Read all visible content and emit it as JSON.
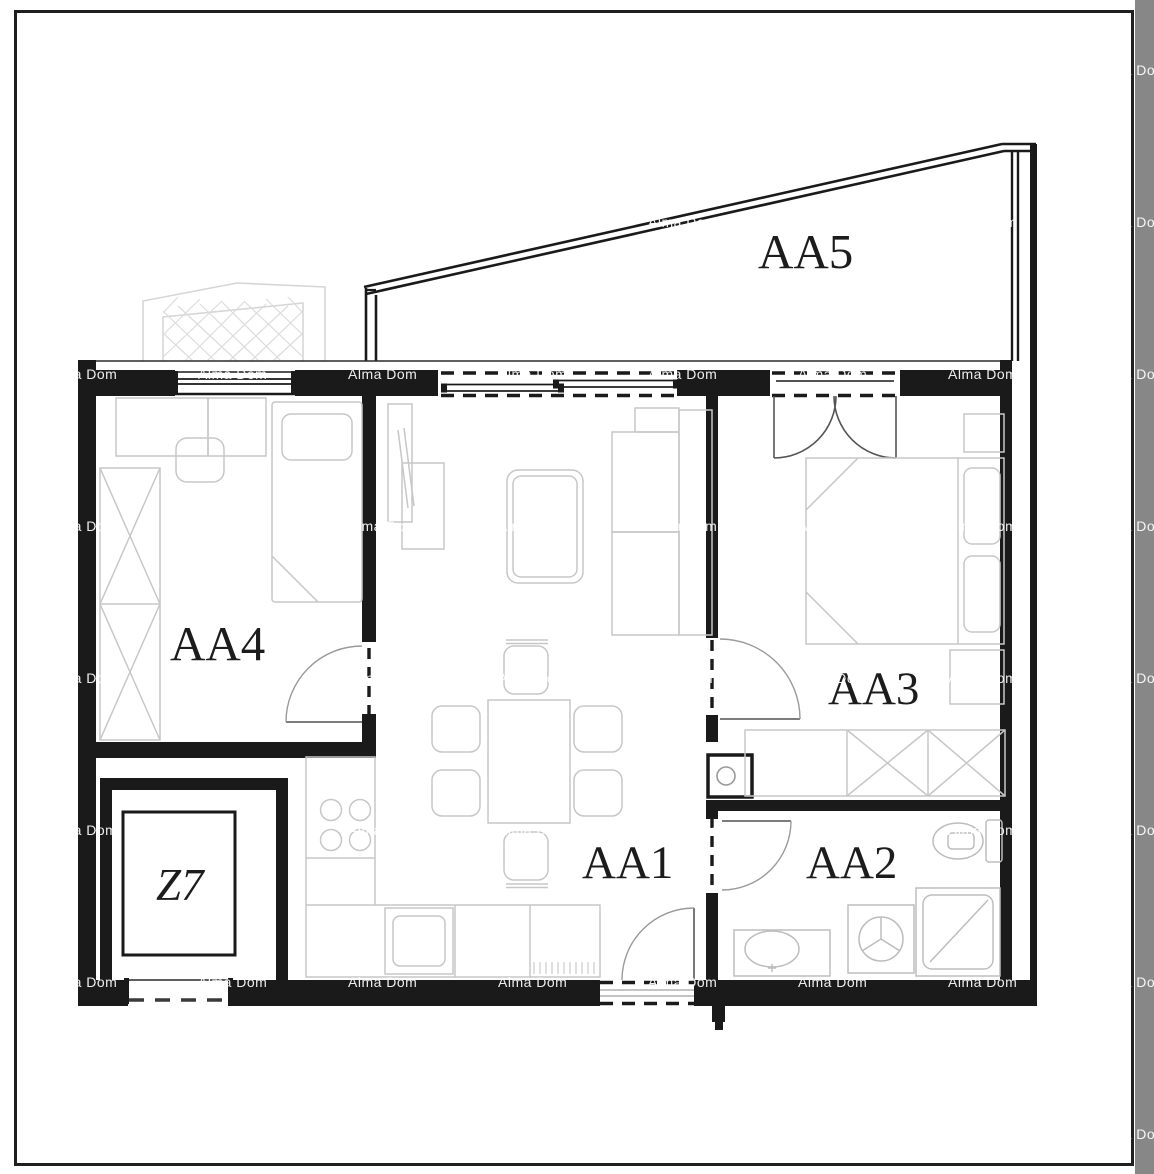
{
  "page": {
    "background": "#ffffff",
    "border_color": "#1f1f1f",
    "right_band_color": "#878787"
  },
  "watermark": {
    "text": "Alma Dom",
    "color": "rgba(255,255,255,0.92)",
    "cols": [
      48,
      198,
      348,
      498,
      648,
      798,
      948,
      1098
    ],
    "rows": [
      62,
      214,
      366,
      518,
      670,
      822,
      974,
      1126
    ]
  },
  "rooms": {
    "aa1": {
      "label": "AA1",
      "type": "living-room-kitchen"
    },
    "aa2": {
      "label": "AA2",
      "type": "bathroom"
    },
    "aa3": {
      "label": "AA3",
      "type": "bedroom"
    },
    "aa4": {
      "label": "AA4",
      "type": "bedroom"
    },
    "aa5": {
      "label": "AA5",
      "type": "terrace"
    },
    "z7": {
      "label": "Z7",
      "type": "storage"
    }
  },
  "colors": {
    "wall": "#1a1a1a",
    "thin_line": "#2a2a2a",
    "furniture": "#c7c7c7",
    "fixture": "#bdbdbd",
    "neighbor_hatch": "#d6d6d6"
  },
  "fixtures": [
    "bed",
    "wardrobe",
    "sofa",
    "coffee-table",
    "dining-table",
    "chairs",
    "kitchen-counter",
    "stove",
    "sink",
    "toilet",
    "shower",
    "washing-machine",
    "elevator-shaft",
    "entry-door",
    "french-doors",
    "sliding-doors"
  ]
}
